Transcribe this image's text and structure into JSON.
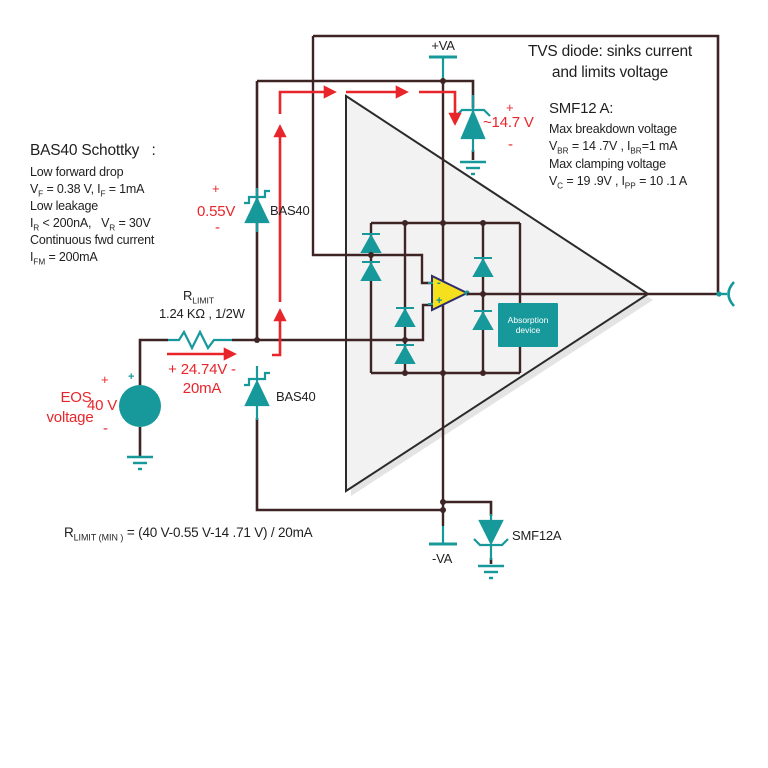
{
  "notes": {
    "bas40": {
      "title": "BAS40 Schottky   :",
      "line1": "Low forward drop",
      "line2": "V{F} = 0.38 V, I{F} = 1mA",
      "line3": "Low leakage",
      "line4": "I{R} < 200nA,   V{R} = 30V",
      "line5": "Continuous fwd current",
      "line6": "I{FM} = 200mA"
    },
    "tvs": {
      "line1": "TVS diode: sinks current",
      "line2": "and limits voltage"
    },
    "smf12": {
      "title": "SMF12 A:",
      "line1": "Max breakdown voltage",
      "line2": "V{BR} = 14 .7V , I{BR}=1 mA",
      "line3": "Max clamping voltage",
      "line4": "V{C} = 19 .9V , I{PP} = 10 .1 A"
    },
    "formula": "R{LIMIT (MIN )} = (40 V-0.55 V-14 .71 V) / 20mA"
  },
  "labels": {
    "supply_pos": "+VA",
    "supply_neg": "-VA",
    "bas40_top": "BAS40",
    "bas40_bottom": "BAS40",
    "smf12a": "SMF12A",
    "rlimit": "R{LIMIT}",
    "rlimit_value": "1.24 KΩ , 1/2W",
    "absorption_line1": "Absorption",
    "absorption_line2": "device",
    "opamp_minus": "-",
    "opamp_plus": "+"
  },
  "annotations": {
    "bas40_drop": {
      "plus": "+",
      "value": "0.55V",
      "minus": "-"
    },
    "tvs_clamp": {
      "plus": "+",
      "value": "~14.7 V",
      "minus": "-"
    },
    "rlimit_drop": {
      "line1": "+ 24.74V -",
      "line2": "20mA"
    },
    "eos": {
      "label_line1": "EOS",
      "label_line2": "voltage",
      "plus": "+",
      "value": "40 V",
      "minus": "-",
      "source_plus": "+"
    }
  },
  "colors": {
    "wire": "#3E2424",
    "component_teal": "#17999B",
    "annotation_red": "#E8252B",
    "opamp_fill": "#F5E01E",
    "opamp_stroke": "#2E2E6E",
    "triangle_fill": "#F2F2F3"
  }
}
